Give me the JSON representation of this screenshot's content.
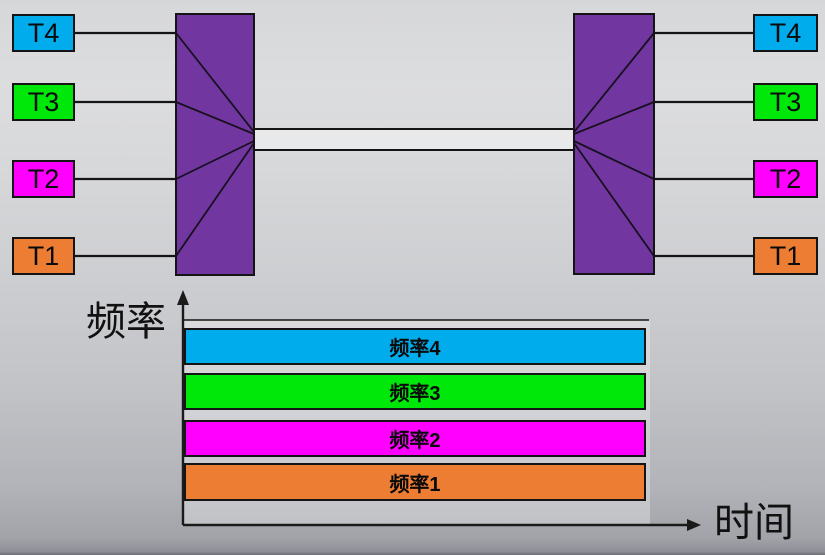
{
  "terminals": {
    "left": [
      {
        "label": "T4",
        "color": "#00ACEC"
      },
      {
        "label": "T3",
        "color": "#00E80A"
      },
      {
        "label": "T2",
        "color": "#FF00FF"
      },
      {
        "label": "T1",
        "color": "#EC7D33"
      }
    ],
    "right": [
      {
        "label": "T4",
        "color": "#00ACEC"
      },
      {
        "label": "T3",
        "color": "#00E80A"
      },
      {
        "label": "T2",
        "color": "#FF00FF"
      },
      {
        "label": "T1",
        "color": "#EC7D33"
      }
    ]
  },
  "mux": {
    "fill": "#7136A0"
  },
  "channel": {
    "fill": "rgba(255,255,255,0.42)"
  },
  "chart": {
    "y_axis_label": "频率",
    "x_axis_label": "时间",
    "plot_fill": "rgba(255,255,255,0.30)",
    "bands": [
      {
        "label": "频率4",
        "color": "#00ACEC"
      },
      {
        "label": "频率3",
        "color": "#00E80A"
      },
      {
        "label": "频率2",
        "color": "#FF00FF"
      },
      {
        "label": "频率1",
        "color": "#EC7D33"
      }
    ]
  },
  "chart_data": {
    "type": "bar",
    "orientation": "horizontal",
    "title": "",
    "categories": [
      "频率4",
      "频率3",
      "频率2",
      "频率1"
    ],
    "values": [
      1,
      1,
      1,
      1
    ],
    "value_meaning": "each frequency band occupies the full time axis (constant over time)",
    "xlabel": "时间",
    "ylabel": "频率",
    "colors": [
      "#00ACEC",
      "#00E80A",
      "#FF00FF",
      "#EC7D33"
    ],
    "grid": false,
    "legend": false
  },
  "colors": {
    "line": "#141414",
    "background_top": "#DBDCDE",
    "background_bottom": "#9EA0A6"
  }
}
